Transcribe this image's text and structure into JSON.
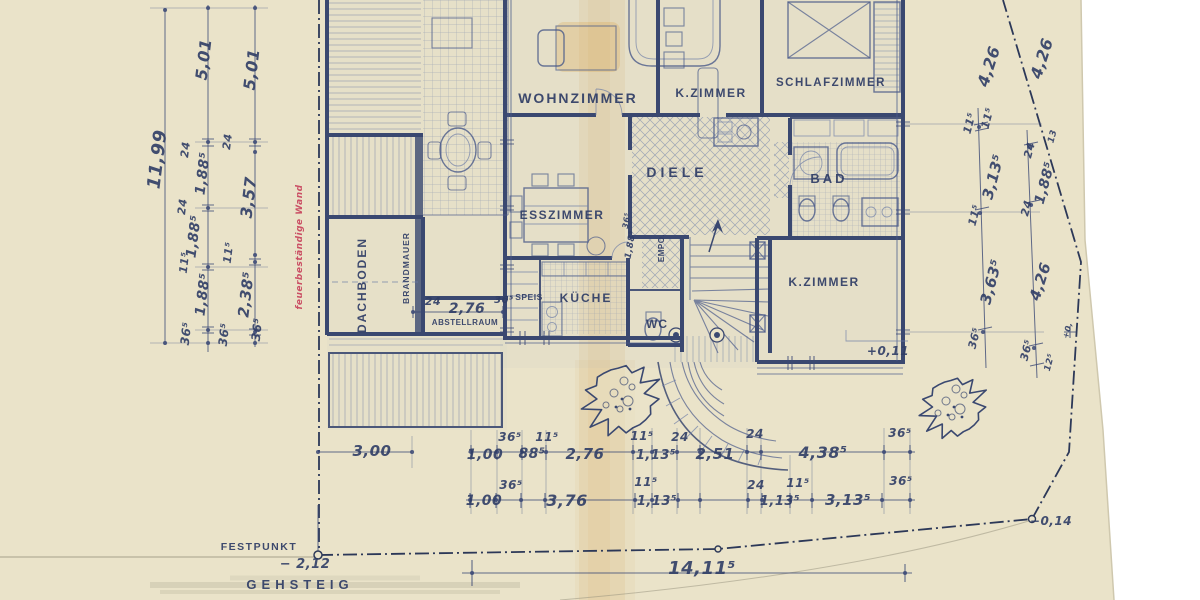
{
  "colors": {
    "paper": "#eae3c9",
    "ink": "#3b4975",
    "ink_text": "#2f3d66",
    "red_note": "#c94960",
    "boundary": "#2c3858",
    "stain": "#d8a855"
  },
  "rooms": [
    {
      "n": "room-label-wohnzimmer",
      "t": "WOHNZIMMER",
      "x": 578,
      "y": 103,
      "s": 14,
      "ls": 2
    },
    {
      "n": "room-label-kzimmer-top",
      "t": "K.ZIMMER",
      "x": 711,
      "y": 97,
      "s": 12,
      "ls": 1.5
    },
    {
      "n": "room-label-schlafzimmer",
      "t": "SCHLAFZIMMER",
      "x": 831,
      "y": 86,
      "s": 11.5,
      "ls": 1.5
    },
    {
      "n": "room-label-diele",
      "t": "DIELE",
      "x": 677,
      "y": 177,
      "s": 14,
      "ls": 4
    },
    {
      "n": "room-label-bad",
      "t": "BAD",
      "x": 829,
      "y": 183,
      "s": 13,
      "ls": 3
    },
    {
      "n": "room-label-esszimmer",
      "t": "ESSZIMMER",
      "x": 562,
      "y": 219,
      "s": 12,
      "ls": 1.5
    },
    {
      "n": "room-label-kueche",
      "t": "KÜCHE",
      "x": 586,
      "y": 302,
      "s": 12,
      "ls": 2
    },
    {
      "n": "room-label-speis",
      "t": "SPEIS",
      "x": 529,
      "y": 300,
      "s": 8.5,
      "ls": 0.5
    },
    {
      "n": "room-label-wc",
      "t": "WC",
      "x": 657,
      "y": 328,
      "s": 12,
      "ls": 1
    },
    {
      "n": "room-label-kzimmer-bottom",
      "t": "K.ZIMMER",
      "x": 824,
      "y": 286,
      "s": 12,
      "ls": 1.5
    },
    {
      "n": "room-label-dachboden",
      "t": "DACHBODEN",
      "x": 366,
      "y": 285,
      "s": 12,
      "r": -90,
      "ls": 2
    },
    {
      "n": "room-label-brandmauer",
      "t": "BRANDMAUER",
      "x": 409,
      "y": 268,
      "s": 8.5,
      "r": -90,
      "ls": 1
    },
    {
      "n": "room-label-abstellraum",
      "t": "ABSTELLRAUM",
      "x": 465,
      "y": 325,
      "s": 8,
      "ls": 0.5
    },
    {
      "n": "room-label-empore",
      "t": "EMPO.",
      "x": 664,
      "y": 248,
      "s": 8,
      "r": -90,
      "ls": 0.5
    }
  ],
  "wall_note": {
    "n": "note-feuerbestaendige-wand",
    "t": "feuerbeständige Wand",
    "x": 302,
    "y": 247,
    "s": 9,
    "r": -90,
    "cls": "hand red"
  },
  "dimensions": {
    "left": [
      {
        "t": "11,99",
        "x": 163,
        "y": 160,
        "s": 18,
        "r": -83
      },
      {
        "t": "5,01",
        "x": 209,
        "y": 60,
        "s": 16,
        "r": -83
      },
      {
        "t": "5,01",
        "x": 257,
        "y": 70,
        "s": 16,
        "r": -83
      },
      {
        "t": "24",
        "x": 189,
        "y": 150,
        "s": 11,
        "r": -83
      },
      {
        "t": "1,88⁵",
        "x": 207,
        "y": 174,
        "s": 14,
        "r": -83
      },
      {
        "t": "24",
        "x": 231,
        "y": 142,
        "s": 11,
        "r": -83
      },
      {
        "t": "24",
        "x": 186,
        "y": 207,
        "s": 11,
        "r": -83
      },
      {
        "t": "1,88⁵",
        "x": 198,
        "y": 237,
        "s": 14,
        "r": -83
      },
      {
        "t": "3,57",
        "x": 254,
        "y": 198,
        "s": 16,
        "r": -83
      },
      {
        "t": "11⁵",
        "x": 188,
        "y": 263,
        "s": 11,
        "r": -83
      },
      {
        "t": "1,88⁵",
        "x": 207,
        "y": 295,
        "s": 14,
        "r": -83
      },
      {
        "t": "11⁵",
        "x": 232,
        "y": 253,
        "s": 11,
        "r": -83
      },
      {
        "t": "2,38⁵",
        "x": 251,
        "y": 295,
        "s": 15,
        "r": -83
      },
      {
        "t": "36⁵",
        "x": 190,
        "y": 334,
        "s": 12,
        "r": -83
      },
      {
        "t": "36⁵",
        "x": 228,
        "y": 335,
        "s": 12,
        "r": -83
      },
      {
        "t": "36⁵",
        "x": 261,
        "y": 330,
        "s": 12,
        "r": -83
      }
    ],
    "right": [
      {
        "t": "4,26",
        "x": 994,
        "y": 68,
        "s": 16,
        "r": -72
      },
      {
        "t": "4,26",
        "x": 1047,
        "y": 60,
        "s": 16,
        "r": -72
      },
      {
        "t": "11⁵",
        "x": 973,
        "y": 124,
        "s": 11,
        "r": -75
      },
      {
        "t": "11⁵",
        "x": 991,
        "y": 119,
        "s": 11,
        "r": -75
      },
      {
        "t": "3,13⁵",
        "x": 998,
        "y": 178,
        "s": 15,
        "r": -75
      },
      {
        "t": "24",
        "x": 1033,
        "y": 151,
        "s": 11,
        "r": -75
      },
      {
        "t": "13",
        "x": 1055,
        "y": 137,
        "s": 9,
        "r": -75
      },
      {
        "t": "1,88⁵",
        "x": 1049,
        "y": 184,
        "s": 14,
        "r": -75
      },
      {
        "t": "11⁵",
        "x": 978,
        "y": 216,
        "s": 11,
        "r": -75
      },
      {
        "t": "24",
        "x": 1030,
        "y": 209,
        "s": 11,
        "r": -75
      },
      {
        "t": "3,63⁵",
        "x": 996,
        "y": 283,
        "s": 15,
        "r": -75
      },
      {
        "t": "4,26",
        "x": 1045,
        "y": 283,
        "s": 15,
        "r": -72
      },
      {
        "t": "36⁵",
        "x": 978,
        "y": 339,
        "s": 11,
        "r": -75
      },
      {
        "t": "36⁵",
        "x": 1030,
        "y": 351,
        "s": 11,
        "r": -75
      },
      {
        "t": "12⁵",
        "x": 1052,
        "y": 363,
        "s": 9,
        "r": -75
      },
      {
        "t": "+0,",
        "x": 1070,
        "y": 331,
        "s": 8,
        "r": -75
      }
    ],
    "building": [
      {
        "t": "24",
        "x": 433,
        "y": 305,
        "s": 11
      },
      {
        "t": "2,76",
        "x": 467,
        "y": 313,
        "s": 14
      },
      {
        "t": "36⁵",
        "x": 504,
        "y": 303,
        "s": 10
      },
      {
        "t": "3,00",
        "x": 372,
        "y": 456,
        "s": 15
      },
      {
        "t": "36⁵",
        "x": 629,
        "y": 221,
        "s": 8,
        "r": -80
      },
      {
        "t": "1,88⁵",
        "x": 633,
        "y": 245,
        "s": 9,
        "r": -80
      },
      {
        "t": "+0,11",
        "x": 888,
        "y": 355,
        "s": 12
      }
    ],
    "bottom_row1": [
      {
        "t": "1,00",
        "x": 485,
        "y": 459,
        "s": 14
      },
      {
        "t": "36⁵",
        "x": 510,
        "y": 441,
        "s": 12
      },
      {
        "t": "88⁵",
        "x": 532,
        "y": 458,
        "s": 14
      },
      {
        "t": "11⁵",
        "x": 547,
        "y": 441,
        "s": 12
      },
      {
        "t": "2,76",
        "x": 585,
        "y": 459,
        "s": 15
      },
      {
        "t": "11⁵",
        "x": 642,
        "y": 440,
        "s": 12
      },
      {
        "t": "1,13⁵",
        "x": 656,
        "y": 459,
        "s": 13
      },
      {
        "t": "24",
        "x": 680,
        "y": 441,
        "s": 12
      },
      {
        "t": "2,51",
        "x": 715,
        "y": 459,
        "s": 15
      },
      {
        "t": "24",
        "x": 755,
        "y": 438,
        "s": 12
      },
      {
        "t": "4,38⁵",
        "x": 823,
        "y": 458,
        "s": 16
      },
      {
        "t": "36⁵",
        "x": 900,
        "y": 437,
        "s": 12
      }
    ],
    "bottom_row2": [
      {
        "t": "1,00",
        "x": 484,
        "y": 505,
        "s": 14
      },
      {
        "t": "36⁵",
        "x": 511,
        "y": 489,
        "s": 12
      },
      {
        "t": "3,76",
        "x": 567,
        "y": 506,
        "s": 16
      },
      {
        "t": "11⁵",
        "x": 646,
        "y": 486,
        "s": 12
      },
      {
        "t": "1,13⁵",
        "x": 657,
        "y": 505,
        "s": 13
      },
      {
        "t": "24",
        "x": 756,
        "y": 489,
        "s": 12
      },
      {
        "t": "1,13⁵",
        "x": 780,
        "y": 505,
        "s": 13
      },
      {
        "t": "11⁵",
        "x": 798,
        "y": 487,
        "s": 12
      },
      {
        "t": "3,13⁵",
        "x": 848,
        "y": 505,
        "s": 15
      },
      {
        "t": "36⁵",
        "x": 901,
        "y": 485,
        "s": 12
      }
    ],
    "site": [
      {
        "t": "14,11⁵",
        "x": 702,
        "y": 574,
        "s": 18
      },
      {
        "t": "− 2,12",
        "x": 305,
        "y": 568,
        "s": 13
      },
      {
        "t": "−0,14",
        "x": 1051,
        "y": 525,
        "s": 12
      }
    ]
  },
  "site_labels": [
    {
      "n": "site-label-festpunkt",
      "t": "FESTPUNKT",
      "x": 259,
      "y": 550,
      "s": 10.5,
      "ls": 1.5,
      "cls": "arch"
    },
    {
      "n": "site-label-gehsteig",
      "t": "GEHSTEIG",
      "x": 300,
      "y": 589,
      "s": 13,
      "ls": 5,
      "cls": "arch"
    }
  ]
}
